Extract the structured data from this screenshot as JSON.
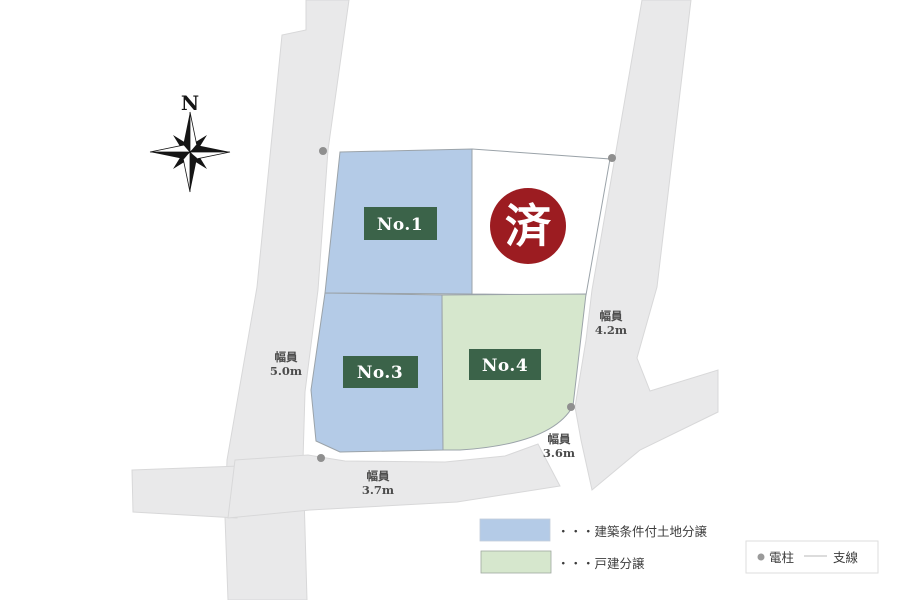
{
  "compass": {
    "label": "N"
  },
  "lots": [
    {
      "id": "no1",
      "label": "No.1"
    },
    {
      "id": "sold",
      "label": "済"
    },
    {
      "id": "no3",
      "label": "No.3"
    },
    {
      "id": "no4",
      "label": "No.4"
    }
  ],
  "road_widths": [
    {
      "label": "幅員",
      "value": "5.0m"
    },
    {
      "label": "幅員",
      "value": "4.2m"
    },
    {
      "label": "幅員",
      "value": "3.7m"
    },
    {
      "label": "幅員",
      "value": "3.6m"
    }
  ],
  "legend": {
    "items": [
      {
        "swatch": "blue",
        "text": "・・・建築条件付土地分譲"
      },
      {
        "swatch": "green",
        "text": "・・・戸建分譲"
      }
    ],
    "symbols": [
      {
        "icon": "pole-dot",
        "text": "電柱"
      },
      {
        "icon": "wire-line",
        "text": "支線"
      }
    ]
  },
  "colors": {
    "lot_blue": "#b4cbe7",
    "lot_green": "#d6e7cd",
    "lot_sold": "#ffffff",
    "road": "#e9e9ea",
    "badge_green": "#3b6349",
    "sold_red": "#9c1c21",
    "pole_gray": "#8f8f8f"
  }
}
